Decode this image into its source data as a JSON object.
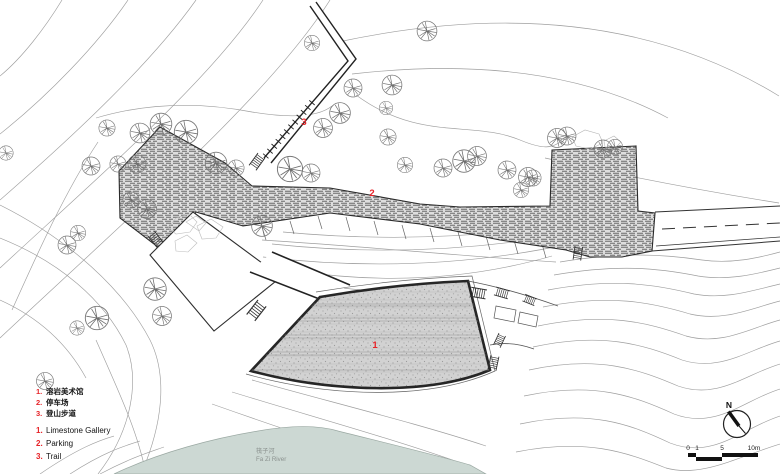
{
  "colors": {
    "accent_red": "#e62328",
    "river_fill": "#ccd8d3",
    "ink": "#1a1a1a",
    "contour_gray": "#9e9e9e"
  },
  "plan_labels": {
    "gallery": "1",
    "parking": "2",
    "trail": "3"
  },
  "legend": {
    "zh_items": [
      {
        "num": "1.",
        "label": "溶岩美术馆"
      },
      {
        "num": "2.",
        "label": "停车场"
      },
      {
        "num": "3.",
        "label": "登山步道"
      }
    ],
    "en_items": [
      {
        "num": "1.",
        "label": "Limestone Gallery"
      },
      {
        "num": "2.",
        "label": "Parking"
      },
      {
        "num": "3.",
        "label": "Trail"
      }
    ]
  },
  "river": {
    "name_zh": "筏子河",
    "name_en": "Fa Zi River"
  },
  "compass": {
    "north_label": "N"
  },
  "scale_bar": {
    "tick_0": "0",
    "tick_1": "1",
    "tick_5": "5",
    "tick_10": "10m"
  }
}
